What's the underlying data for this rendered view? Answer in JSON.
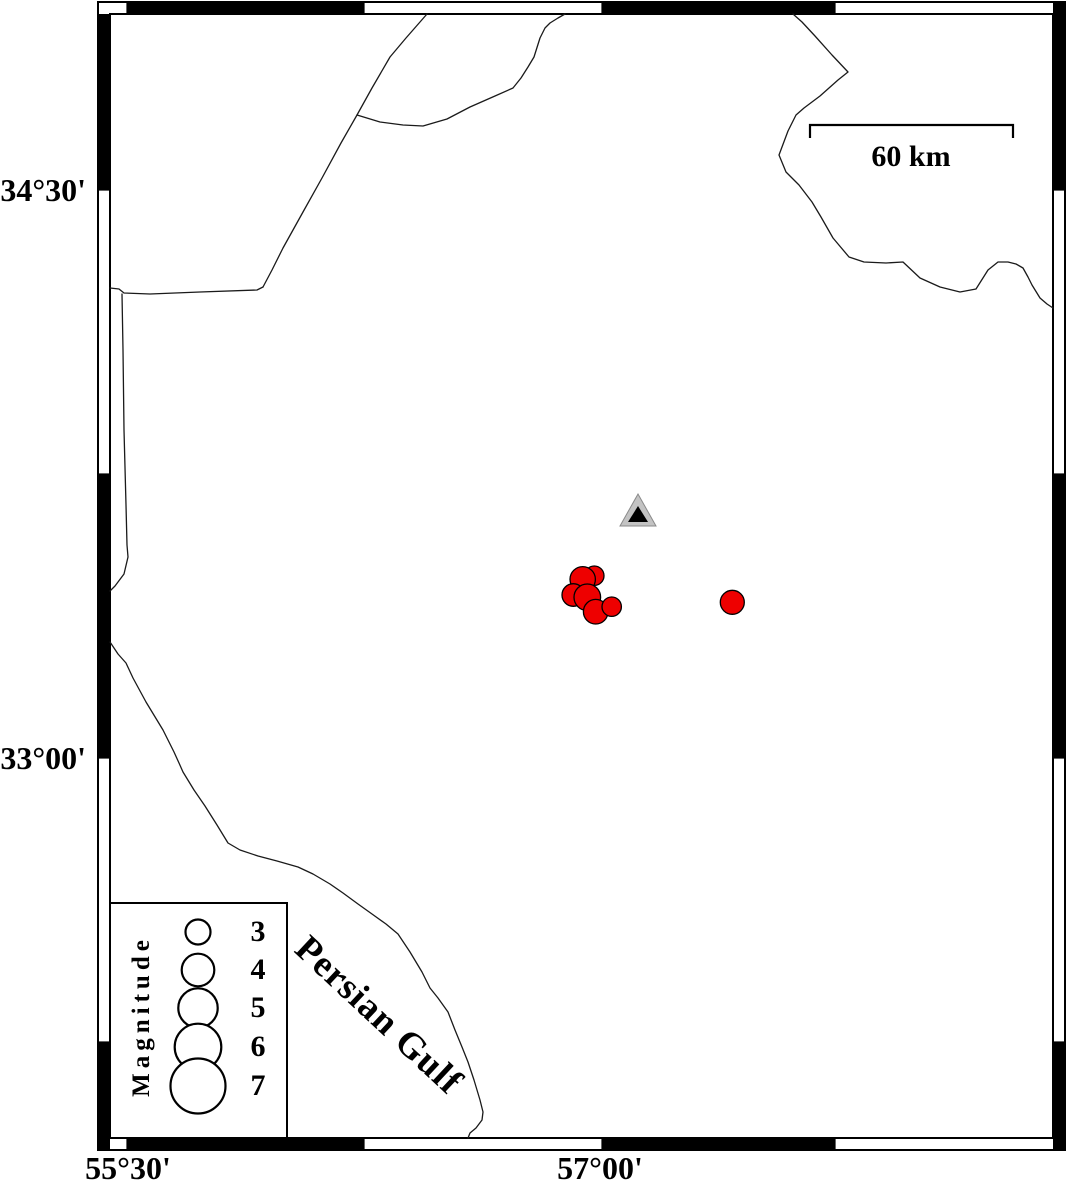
{
  "figure": {
    "type": "seismicity-map",
    "sea_label": "Persian Gulf",
    "scale_bar": {
      "label": "60 km",
      "x1": 810,
      "x2": 1013,
      "y": 125,
      "tick_drop": 13,
      "label_cx": 911,
      "label_cy": 157
    },
    "axes": {
      "lat_ticks": [
        {
          "label": "34°30'",
          "y": 190
        },
        {
          "label": "33°00'",
          "y": 758
        }
      ],
      "lon_ticks": [
        {
          "label": "55°30'",
          "x": 128
        },
        {
          "label": "57°00'",
          "x": 600
        }
      ],
      "bounds": {
        "lon_min": 55.45,
        "lon_max": 58.44,
        "lat_min": 32.0,
        "lat_max": 34.97
      }
    },
    "legend": {
      "title": "Magnitude",
      "box": {
        "x": 110,
        "y": 903,
        "w": 177,
        "h": 235
      },
      "circle_x": 198,
      "label_x": 236,
      "entries": [
        {
          "magnitude": "3",
          "y": 932,
          "r": 12.5
        },
        {
          "magnitude": "4",
          "y": 970,
          "r": 16.3
        },
        {
          "magnitude": "5",
          "y": 1008,
          "r": 19.7
        },
        {
          "magnitude": "6",
          "y": 1047,
          "r": 23.3
        },
        {
          "magnitude": "7",
          "y": 1086,
          "r": 27.5
        }
      ]
    },
    "station": {
      "x": 638,
      "y": 515,
      "lon": 57.12,
      "lat": 33.64
    },
    "events": [
      {
        "x": 594.3,
        "y": 575.7,
        "r": 9.7,
        "lon": 56.98,
        "lat": 33.48,
        "magnitude_approx": 2.3
      },
      {
        "x": 582.7,
        "y": 579.3,
        "r": 12.7,
        "lon": 56.95,
        "lat": 33.47,
        "magnitude_approx": 3.1
      },
      {
        "x": 573.3,
        "y": 595.0,
        "r": 11.3,
        "lon": 56.92,
        "lat": 33.43,
        "magnitude_approx": 2.7
      },
      {
        "x": 587.3,
        "y": 597.3,
        "r": 13.3,
        "lon": 56.96,
        "lat": 33.42,
        "magnitude_approx": 3.2
      },
      {
        "x": 595.7,
        "y": 611.7,
        "r": 12.3,
        "lon": 56.99,
        "lat": 33.39,
        "magnitude_approx": 2.9
      },
      {
        "x": 611.7,
        "y": 606.7,
        "r": 9.7,
        "lon": 57.04,
        "lat": 33.4,
        "magnitude_approx": 2.3
      },
      {
        "x": 732.3,
        "y": 602.3,
        "r": 12.0,
        "lon": 57.42,
        "lat": 33.41,
        "magnitude_approx": 2.9
      }
    ],
    "borders": {
      "border-northeast": [
        [
          427,
          14
        ],
        [
          406,
          38
        ],
        [
          390,
          57
        ],
        [
          372,
          88
        ],
        [
          357,
          115
        ],
        [
          341,
          143
        ],
        [
          322,
          178
        ],
        [
          303,
          212
        ],
        [
          283,
          248
        ],
        [
          272,
          270
        ],
        [
          263,
          287
        ]
      ],
      "border-west-horizontal": [
        [
          110,
          288
        ],
        [
          119,
          289
        ],
        [
          124,
          293
        ],
        [
          150,
          294
        ],
        [
          200,
          292
        ],
        [
          257,
          290
        ],
        [
          263,
          287
        ]
      ],
      "border-west-vertical": [
        [
          122,
          294
        ],
        [
          123,
          350
        ],
        [
          124,
          430
        ],
        [
          126,
          505
        ],
        [
          127,
          545
        ],
        [
          128,
          557
        ],
        [
          124,
          574
        ],
        [
          115,
          586
        ],
        [
          110,
          591
        ]
      ],
      "border-wedge": [
        [
          357,
          115
        ],
        [
          380,
          122
        ],
        [
          403,
          125
        ],
        [
          423,
          126
        ],
        [
          447,
          119
        ],
        [
          470,
          107
        ],
        [
          495,
          96
        ],
        [
          513,
          88
        ],
        [
          521,
          78
        ],
        [
          528,
          67
        ],
        [
          534,
          57
        ],
        [
          540,
          38
        ],
        [
          545,
          28
        ],
        [
          550,
          23
        ],
        [
          558,
          18
        ],
        [
          565,
          14
        ]
      ],
      "border-east": [
        [
          793,
          14
        ],
        [
          802,
          22
        ],
        [
          815,
          36
        ],
        [
          832,
          55
        ],
        [
          848,
          72
        ],
        [
          838,
          80
        ],
        [
          820,
          96
        ],
        [
          804,
          108
        ],
        [
          796,
          115
        ],
        [
          788,
          131
        ],
        [
          779,
          155
        ],
        [
          786,
          172
        ],
        [
          799,
          185
        ],
        [
          812,
          202
        ],
        [
          821,
          217
        ],
        [
          833,
          238
        ],
        [
          849,
          257
        ],
        [
          864,
          262
        ],
        [
          886,
          263
        ],
        [
          903,
          262
        ],
        [
          920,
          278
        ],
        [
          940,
          287
        ],
        [
          960,
          292
        ],
        [
          976,
          289
        ],
        [
          988,
          270
        ],
        [
          998,
          262
        ],
        [
          1008,
          262
        ],
        [
          1016,
          264
        ],
        [
          1023,
          268
        ],
        [
          1028,
          277
        ],
        [
          1032,
          285
        ],
        [
          1040,
          298
        ],
        [
          1047,
          304
        ],
        [
          1053,
          308
        ]
      ],
      "coastline-persian-gulf": [
        [
          110,
          642
        ],
        [
          118,
          654
        ],
        [
          126,
          663
        ],
        [
          133,
          678
        ],
        [
          146,
          702
        ],
        [
          163,
          730
        ],
        [
          174,
          752
        ],
        [
          179,
          763
        ],
        [
          183,
          772
        ],
        [
          194,
          790
        ],
        [
          205,
          806
        ],
        [
          217,
          825
        ],
        [
          228,
          843
        ],
        [
          240,
          850
        ],
        [
          258,
          856
        ],
        [
          277,
          861
        ],
        [
          298,
          867
        ],
        [
          313,
          874
        ],
        [
          330,
          884
        ],
        [
          343,
          893
        ],
        [
          358,
          904
        ],
        [
          372,
          914
        ],
        [
          386,
          924
        ],
        [
          398,
          934
        ],
        [
          410,
          952
        ],
        [
          422,
          972
        ],
        [
          430,
          988
        ],
        [
          438,
          998
        ],
        [
          448,
          1012
        ],
        [
          455,
          1030
        ],
        [
          462,
          1047
        ],
        [
          468,
          1062
        ],
        [
          474,
          1080
        ],
        [
          480,
          1100
        ],
        [
          483,
          1112
        ],
        [
          482,
          1120
        ],
        [
          476,
          1128
        ],
        [
          470,
          1133
        ],
        [
          468,
          1138
        ]
      ]
    },
    "frame": {
      "outer": {
        "x": 98,
        "y": 2,
        "w": 967,
        "h": 1148
      },
      "inner": {
        "x": 110,
        "y": 14,
        "w": 943,
        "h": 1124
      },
      "top_black": [
        [
          127,
          364
        ],
        [
          602,
          835
        ]
      ],
      "bottom_black": [
        [
          127,
          364
        ],
        [
          602,
          835
        ]
      ],
      "left_black": [
        [
          14,
          190
        ],
        [
          474,
          758
        ],
        [
          1042,
          1150
        ]
      ],
      "right_black": [
        [
          2,
          190
        ],
        [
          474,
          758
        ],
        [
          1042,
          1150
        ]
      ],
      "x_bounds": [
        127,
        364,
        602,
        835
      ],
      "y_bounds": [
        190,
        474,
        758,
        1042
      ]
    },
    "colors": {
      "event_fill": "#ee0000",
      "station_fill": "#c3c3c3",
      "station_inner": "#000000",
      "line": "#1a1a1a",
      "frame": "#000000"
    }
  }
}
